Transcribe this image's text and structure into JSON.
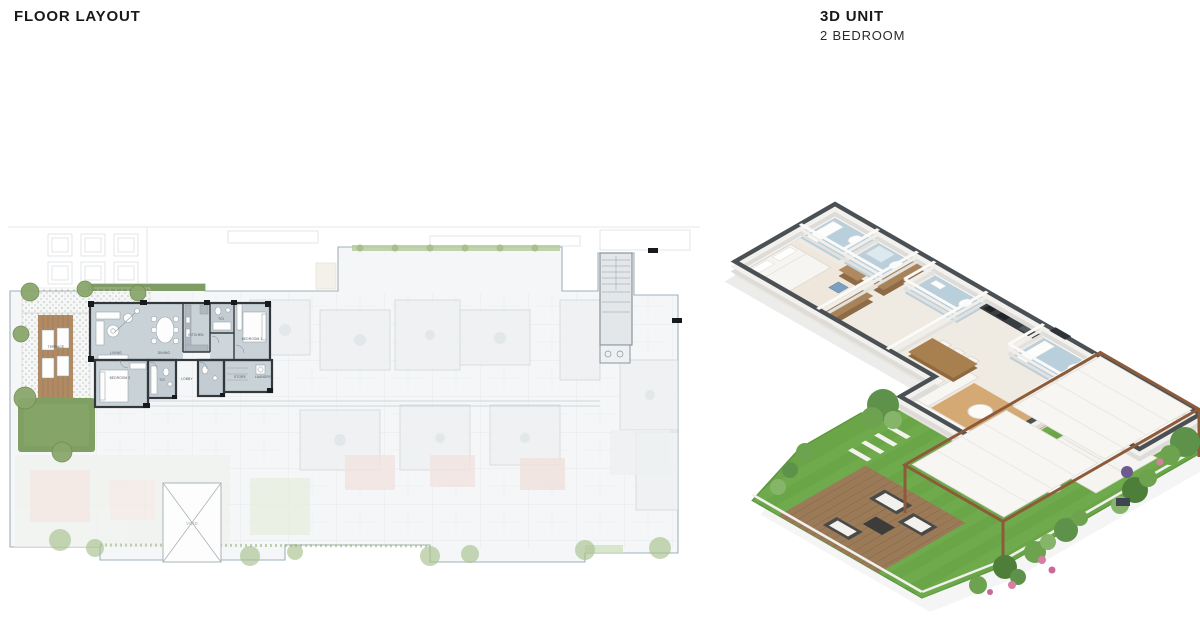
{
  "header": {
    "left_title": "FLOOR LAYOUT",
    "right_title": "3D UNIT",
    "right_subtitle": "2 BEDROOM"
  },
  "floor_plan": {
    "unit_rooms": [
      {
        "label": "TERRACE"
      },
      {
        "label": "LIVING"
      },
      {
        "label": "DINING"
      },
      {
        "label": "KITCHEN"
      },
      {
        "label": "TOI"
      },
      {
        "label": "BEDROOM 1"
      },
      {
        "label": "BEDROOM 2"
      },
      {
        "label": "TOI"
      },
      {
        "label": "LOBBY"
      },
      {
        "label": "STORE"
      },
      {
        "label": "LAUNDRY"
      }
    ],
    "void_label": "VOID"
  },
  "palette": {
    "title_text": "#191919",
    "unit_wall": "#33383d",
    "unit_room_fill": "#c8d2d7",
    "plan_faded_fill": "#f4f6f7",
    "plan_boundary": "#9fb0ba",
    "terrace_wood": "#b08a63",
    "grass_2d": "#7f9f63",
    "wall_top_3d": "#4b5054",
    "floor_3d": "#f0ebe2",
    "bath_floor_3d": "#b9cfdb",
    "lawn_3d": "#6aa648",
    "deck_3d": "#9b7a58",
    "pergola_frame": "#8d5a3a",
    "rug_3d": "#d4a974"
  }
}
